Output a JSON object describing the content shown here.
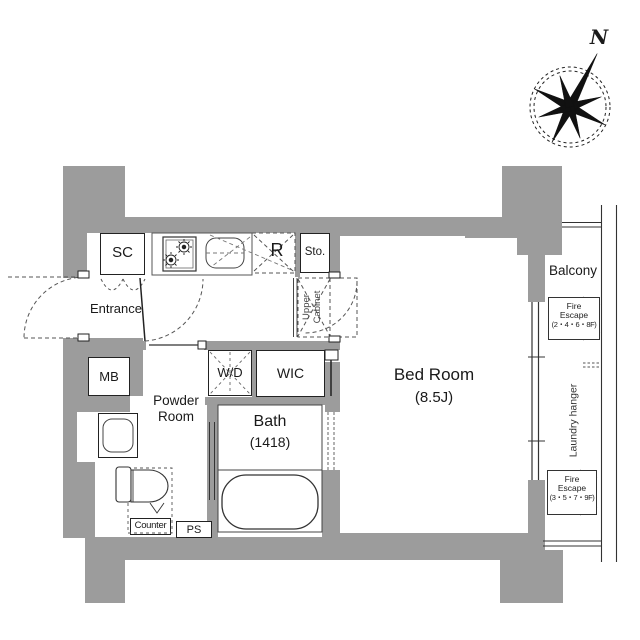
{
  "colors": {
    "wall": "#9c9c9c",
    "line": "#222222",
    "dash": "#555555"
  },
  "compass": {
    "north_label": "N"
  },
  "kitchen": {
    "shoe_closet": "SC",
    "refrigerator": "R",
    "storage": "Sto.",
    "upper_cabinet_lines": [
      "Upper",
      "Cabinet"
    ]
  },
  "entrance": {
    "label": "Entrance",
    "meter_box": "MB"
  },
  "utility": {
    "washer_dryer": "W/D",
    "walk_in_closet": "WIC",
    "pipe_space": "PS"
  },
  "powder_room": {
    "label_lines": [
      "Powder",
      "Room"
    ],
    "counter": "Counter"
  },
  "bath": {
    "label": "Bath",
    "size": "(1418)"
  },
  "bedroom": {
    "label": "Bed Room",
    "size": "(8.5J)"
  },
  "balcony": {
    "label": "Balcony",
    "fire_escape_upper": {
      "lines": [
        "Fire",
        "Escape",
        "(2・4・6・8F)"
      ]
    },
    "fire_escape_lower": {
      "lines": [
        "Fire",
        "Escape",
        "(3・5・7・9F)"
      ]
    },
    "laundry_hanger": "Laundry hanger"
  }
}
